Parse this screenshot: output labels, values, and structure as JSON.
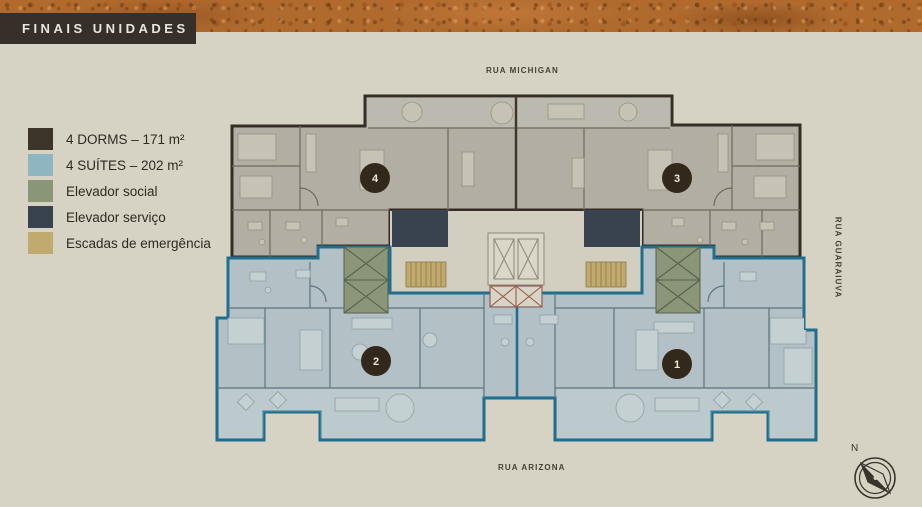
{
  "header": {
    "title": "FINAIS UNIDADES"
  },
  "legend": {
    "items": [
      {
        "label": "4 DORMS – 171 m²",
        "color": "#3d342a"
      },
      {
        "label": "4 SUÍTES – 202 m²",
        "color": "#8fb6c0"
      },
      {
        "label": "Elevador social",
        "color": "#8a9677"
      },
      {
        "label": "Elevador serviço",
        "color": "#39424f"
      },
      {
        "label": "Escadas de emergência",
        "color": "#c0aa6e"
      }
    ]
  },
  "streets": {
    "top": "RUA MICHIGAN",
    "bottom": "RUA ARIZONA",
    "right": "RUA GUARAIUVA"
  },
  "plan": {
    "units": [
      {
        "number": "4"
      },
      {
        "number": "3"
      },
      {
        "number": "2"
      },
      {
        "number": "1"
      }
    ]
  },
  "compass": {
    "label": "N"
  },
  "colors": {
    "background": "#d6d2c4",
    "header_bg": "#37302a",
    "dorms_fill": "#b2aea3",
    "dorms_outline": "#362e24",
    "suites_fill": "#b3c1c6",
    "suites_outline": "#1f6e8e",
    "elevator_social": "#8a9677",
    "elevator_service": "#39424f",
    "stairs": "#c0aa6e",
    "lobby": "#d2cfc1",
    "badge": "#32281c"
  }
}
